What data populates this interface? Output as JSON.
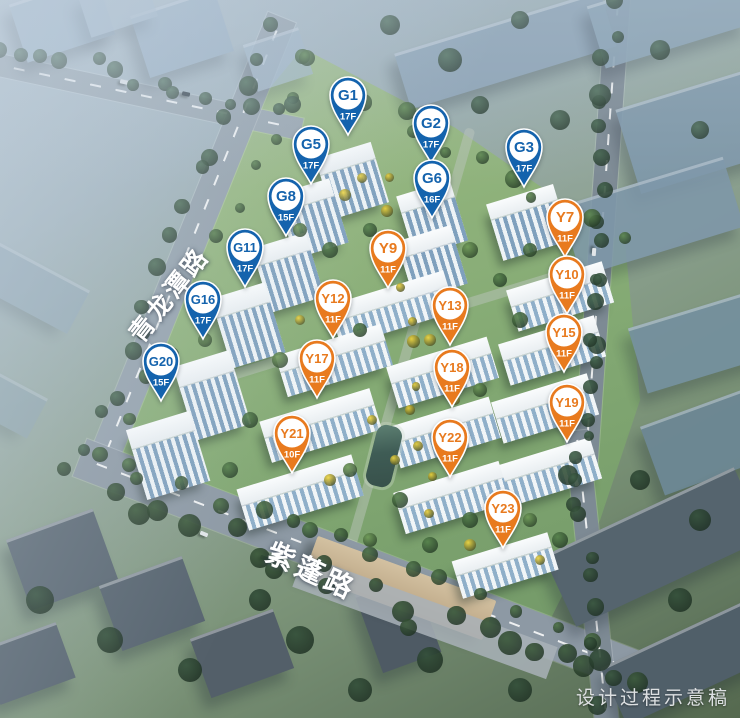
{
  "caption": "设计过程示意稿",
  "roads": {
    "left_label": "青龙潭路",
    "bottom_label": "紫蓬路"
  },
  "marker_colors": {
    "g_series": "#1463ad",
    "y_series": "#e87a1e",
    "pin_center": "#ffffff"
  },
  "markers": [
    {
      "id": "G1",
      "floors": "17F",
      "series": "G",
      "x": 348,
      "y": 95
    },
    {
      "id": "G2",
      "floors": "17F",
      "series": "G",
      "x": 431,
      "y": 123
    },
    {
      "id": "G3",
      "floors": "17F",
      "series": "G",
      "x": 524,
      "y": 147
    },
    {
      "id": "G5",
      "floors": "17F",
      "series": "G",
      "x": 311,
      "y": 144
    },
    {
      "id": "G6",
      "floors": "16F",
      "series": "G",
      "x": 432,
      "y": 178
    },
    {
      "id": "G8",
      "floors": "15F",
      "series": "G",
      "x": 286,
      "y": 196
    },
    {
      "id": "G11",
      "floors": "17F",
      "series": "G",
      "x": 245,
      "y": 247
    },
    {
      "id": "G16",
      "floors": "17F",
      "series": "G",
      "x": 203,
      "y": 299
    },
    {
      "id": "G20",
      "floors": "15F",
      "series": "G",
      "x": 161,
      "y": 361
    },
    {
      "id": "Y7",
      "floors": "11F",
      "series": "Y",
      "x": 565,
      "y": 217
    },
    {
      "id": "Y9",
      "floors": "11F",
      "series": "Y",
      "x": 388,
      "y": 248
    },
    {
      "id": "Y10",
      "floors": "11F",
      "series": "Y",
      "x": 567,
      "y": 274
    },
    {
      "id": "Y12",
      "floors": "11F",
      "series": "Y",
      "x": 333,
      "y": 298
    },
    {
      "id": "Y13",
      "floors": "11F",
      "series": "Y",
      "x": 450,
      "y": 305
    },
    {
      "id": "Y15",
      "floors": "11F",
      "series": "Y",
      "x": 564,
      "y": 332
    },
    {
      "id": "Y17",
      "floors": "11F",
      "series": "Y",
      "x": 317,
      "y": 358
    },
    {
      "id": "Y18",
      "floors": "11F",
      "series": "Y",
      "x": 452,
      "y": 367
    },
    {
      "id": "Y19",
      "floors": "11F",
      "series": "Y",
      "x": 567,
      "y": 402
    },
    {
      "id": "Y21",
      "floors": "10F",
      "series": "Y",
      "x": 292,
      "y": 433
    },
    {
      "id": "Y22",
      "floors": "11F",
      "series": "Y",
      "x": 450,
      "y": 437
    },
    {
      "id": "Y23",
      "floors": "11F",
      "series": "Y",
      "x": 503,
      "y": 508
    }
  ]
}
